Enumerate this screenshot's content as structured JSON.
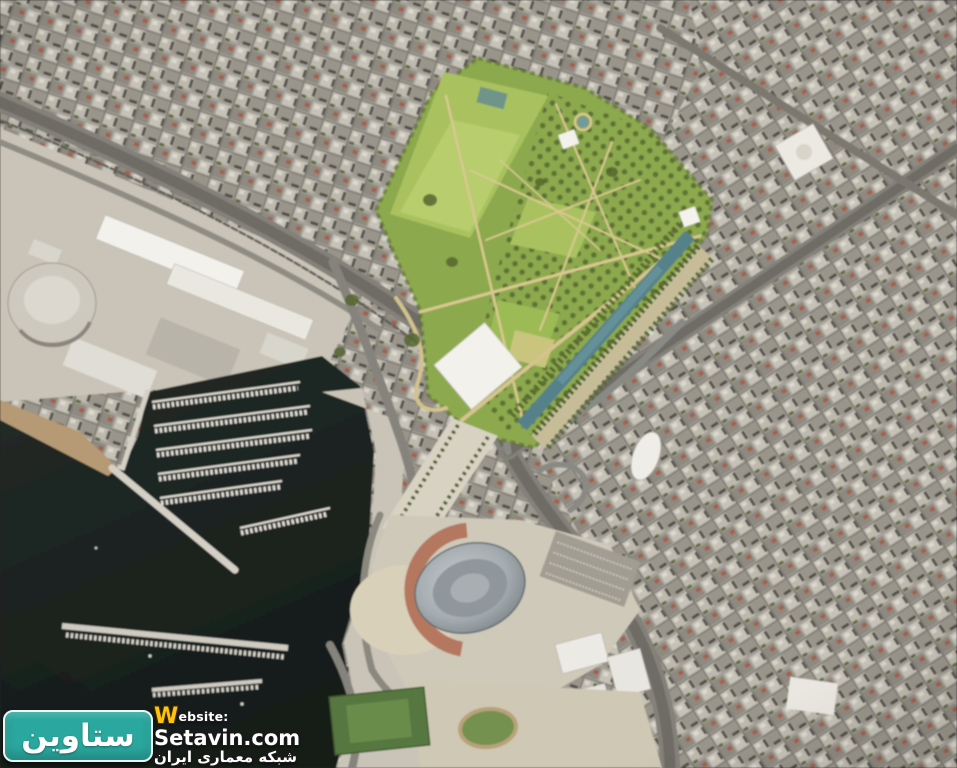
{
  "watermark": {
    "badge_text": "ستاوین",
    "website_w": "W",
    "website_rest": "ebsite:",
    "domain": "Setavin.com",
    "subtitle_fa": "شبکه معماری ایران",
    "badge_color": "#2aa79e",
    "w_color": "#ffc20e",
    "text_color": "#ffffff"
  },
  "palette": {
    "urban_base": "#a5a198",
    "block_light": "#c6c2b7",
    "block_dark": "#8e8a81",
    "block_mid": "#9a958a",
    "block_pale": "#bdb9ae",
    "shadow": "#55524b",
    "roof_white": "#ddd9cf",
    "roof_terracotta": "#a5604a",
    "street": "#7d7a72",
    "pavement": "#c9c4b7",
    "quay": "#d4d0c6",
    "beach": "#b59a74",
    "sea_deep": "#161c19",
    "sea_shallow": "#232b27",
    "pier": "#dcd8ce",
    "boat": "#e3e0d8",
    "road": "#84817a",
    "road_dark": "#6e6c65",
    "rail": "#5f5d57",
    "park_base": "#8ca94e",
    "lawn": "#a9c25f",
    "lawn_bright": "#b7cd6e",
    "orchard_dot": "#5f7236",
    "tree_dark": "#4f6030",
    "khaki_band": "#c6bd98",
    "path_tan": "#d9c88f",
    "canal": "#55828a",
    "canal_light": "#6c97a0",
    "pond": "#6f9a9e",
    "white_building": "#f3f1ec",
    "esplanade": "#d8d2c2",
    "plaza": "#cfc9ba",
    "sand": "#d9d0ba",
    "stadium_red": "#b06e55",
    "parking": "#a29d92",
    "pitch": "#567840",
    "pitch_light": "#6b8c4c",
    "track": "#b8a27a"
  }
}
